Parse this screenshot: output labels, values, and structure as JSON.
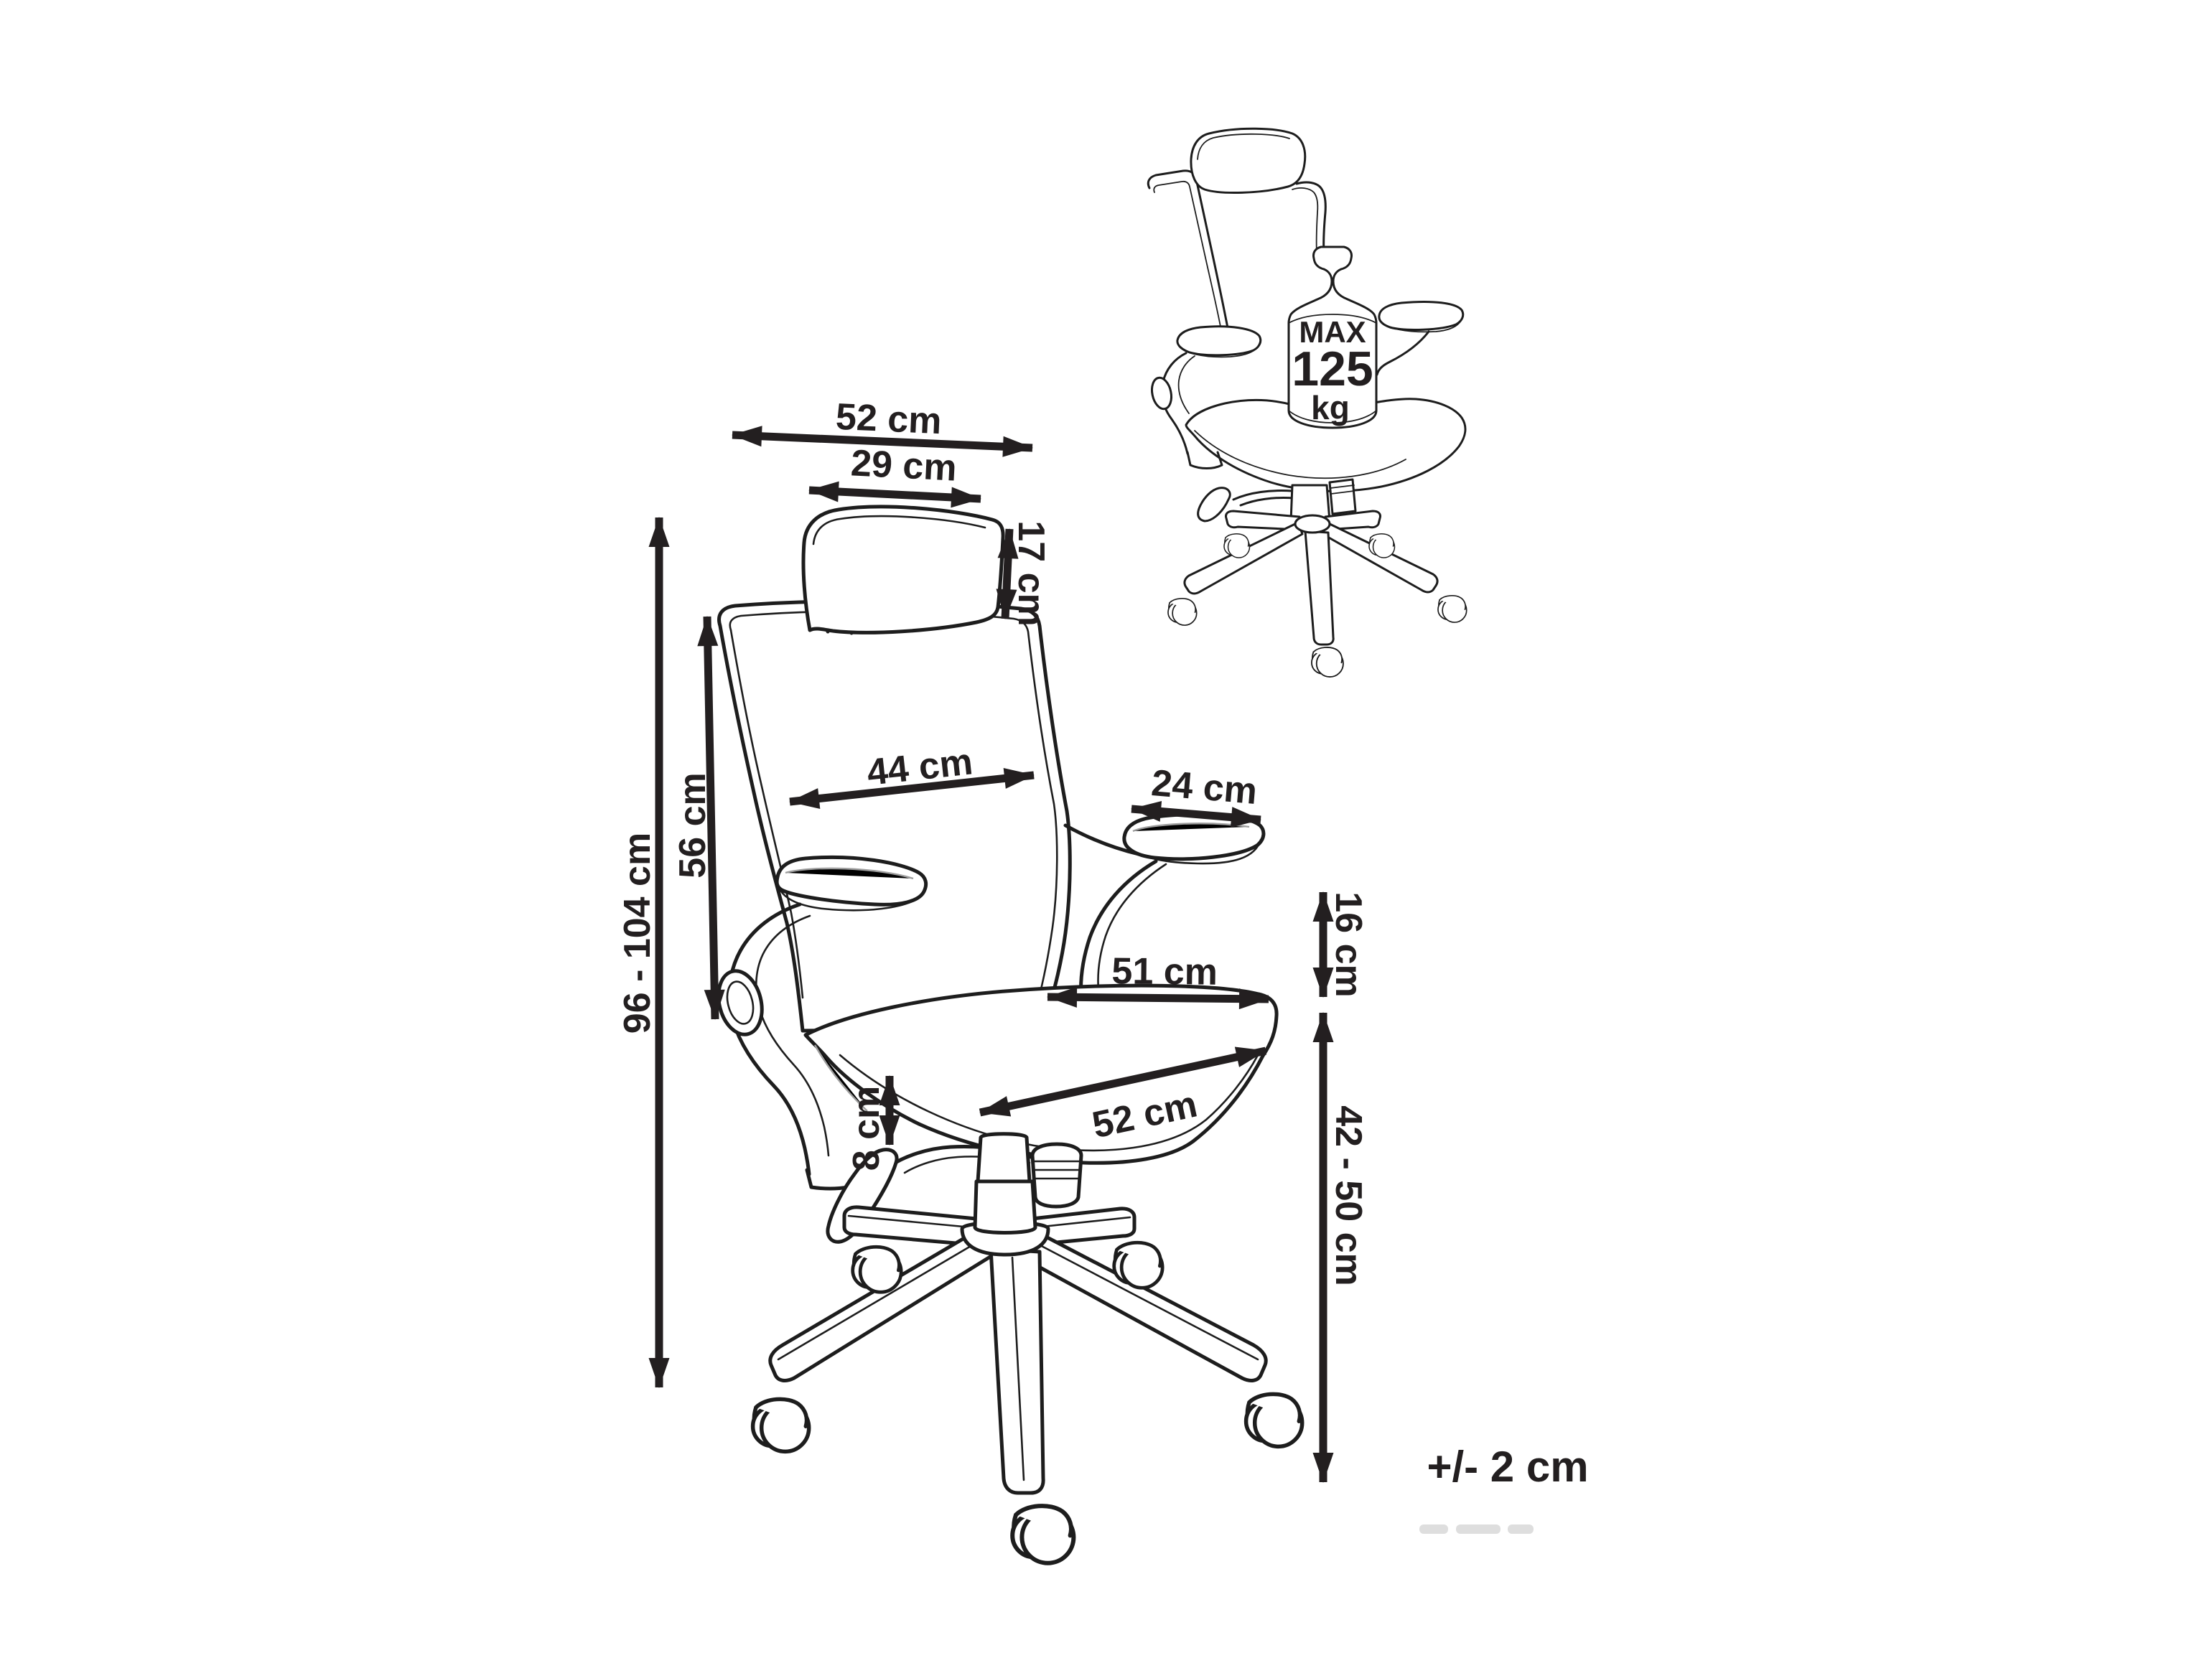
{
  "diagram": {
    "type": "product-dimension-diagram",
    "subject": "office chair",
    "tolerance_note": "+/- 2 cm",
    "max_load_badge": {
      "line1": "MAX",
      "line2": "125",
      "line3": "kg",
      "combined": "MAX 125 kg"
    },
    "colors": {
      "ink": "#231f20",
      "outline": "#1d1d1d",
      "secondary_line": "#9e9e9e",
      "paper": "#ffffff"
    },
    "measurements": {
      "total_width": {
        "label": "52 cm"
      },
      "headrest_width": {
        "label": "29 cm"
      },
      "headrest_height": {
        "label": "17 cm"
      },
      "backrest_width": {
        "label": "44 cm"
      },
      "backrest_height": {
        "label": "56 cm"
      },
      "total_height": {
        "label": "96 - 104 cm"
      },
      "armrest_length": {
        "label": "24 cm"
      },
      "armrest_height": {
        "label": "16 cm"
      },
      "seat_width": {
        "label": "51 cm"
      },
      "seat_depth": {
        "label": "52 cm"
      },
      "seat_thickness": {
        "label": "8 cm"
      },
      "seat_height": {
        "label": "42 - 50 cm"
      }
    }
  }
}
